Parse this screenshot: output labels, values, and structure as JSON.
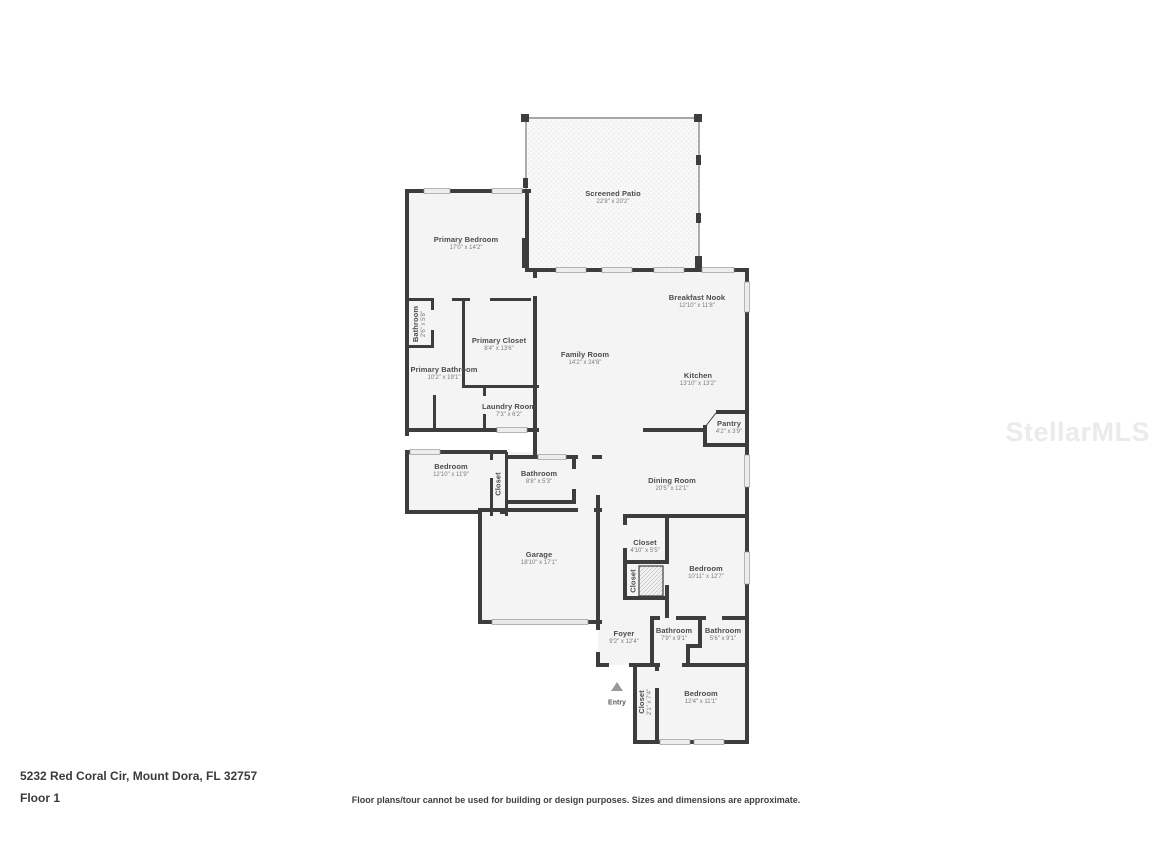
{
  "watermark": "StellarMLS",
  "footer": {
    "address": "5232 Red Coral Cir, Mount Dora, FL 32757",
    "floor_label": "Floor 1",
    "disclaimer": "Floor plans/tour cannot be used for building or design purposes. Sizes and dimensions are approximate."
  },
  "entry": {
    "label": "Entry"
  },
  "colors": {
    "wall": "#3d3d3d",
    "floor": "#f4f4f4",
    "patio_floor": "#f8f8f8",
    "window": "#ededed",
    "watermark": "#ebebeb"
  },
  "rooms": [
    {
      "id": "screened-patio",
      "name": "Screened Patio",
      "dims": "22'8\" x 20'2\""
    },
    {
      "id": "primary-bedroom",
      "name": "Primary Bedroom",
      "dims": "17'0\" x 14'2\""
    },
    {
      "id": "bathroom-small",
      "name": "Bathroom",
      "dims": "2'6\" x 5'8\""
    },
    {
      "id": "primary-closet",
      "name": "Primary Closet",
      "dims": "8'4\" x 13'6\""
    },
    {
      "id": "primary-bathroom",
      "name": "Primary Bathroom",
      "dims": "10'2\" x 19'1\""
    },
    {
      "id": "laundry-room",
      "name": "Laundry Room",
      "dims": "7'3\" x 6'2\""
    },
    {
      "id": "family-room",
      "name": "Family Room",
      "dims": "14'2\" x 24'8\""
    },
    {
      "id": "breakfast-nook",
      "name": "Breakfast Nook",
      "dims": "12'10\" x 11'8\""
    },
    {
      "id": "kitchen",
      "name": "Kitchen",
      "dims": "13'10\" x 13'2\""
    },
    {
      "id": "pantry",
      "name": "Pantry",
      "dims": "4'2\" x 3'9\""
    },
    {
      "id": "bedroom-left",
      "name": "Bedroom",
      "dims": "12'10\" x 11'9\""
    },
    {
      "id": "closet-bedroom-left",
      "name": "Closet",
      "dims": ""
    },
    {
      "id": "bathroom-mid",
      "name": "Bathroom",
      "dims": "8'8\" x 5'3\""
    },
    {
      "id": "dining-room",
      "name": "Dining Room",
      "dims": "20'5\" x 12'1\""
    },
    {
      "id": "garage",
      "name": "Garage",
      "dims": "18'10\" x 17'1\""
    },
    {
      "id": "closet-hall",
      "name": "Closet",
      "dims": "4'10\" x 5'5\""
    },
    {
      "id": "closet-hatched",
      "name": "Closet",
      "dims": ""
    },
    {
      "id": "bedroom-mid",
      "name": "Bedroom",
      "dims": "10'11\" x 12'7\""
    },
    {
      "id": "foyer",
      "name": "Foyer",
      "dims": "9'2\" x 12'4\""
    },
    {
      "id": "bathroom-b1",
      "name": "Bathroom",
      "dims": "7'9\" x 9'1\""
    },
    {
      "id": "bathroom-b2",
      "name": "Bathroom",
      "dims": "5'6\" x 9'1\""
    },
    {
      "id": "bedroom-bottom",
      "name": "Bedroom",
      "dims": "12'4\" x 11'1\""
    },
    {
      "id": "closet-bottom",
      "name": "Closet",
      "dims": "2'1\" x 7'4\""
    }
  ]
}
